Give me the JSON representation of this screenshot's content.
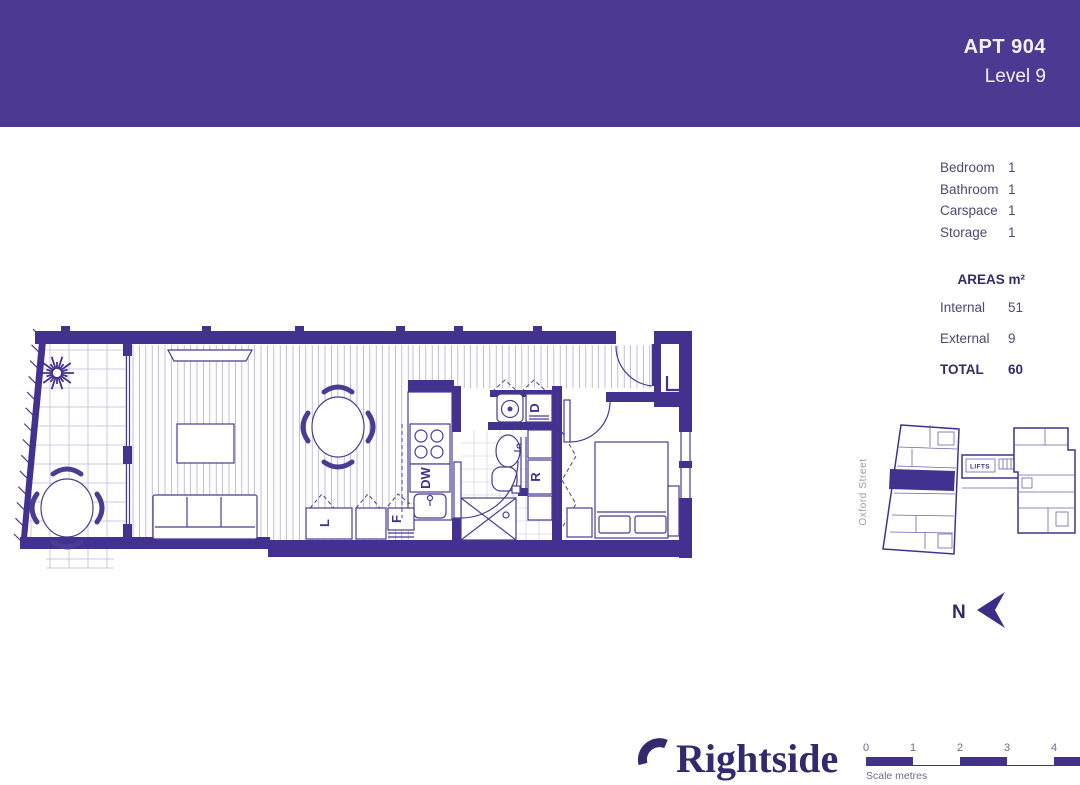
{
  "header": {
    "apt": "APT 904",
    "level": "Level 9"
  },
  "summary": {
    "rows": [
      {
        "label": "Bedroom",
        "value": "1"
      },
      {
        "label": "Bathroom",
        "value": "1"
      },
      {
        "label": "Carspace",
        "value": "1"
      },
      {
        "label": "Storage",
        "value": "1"
      }
    ]
  },
  "areas": {
    "title": "AREAS m²",
    "rows": [
      {
        "label": "Internal",
        "value": "51"
      },
      {
        "label": "External",
        "value": "9"
      }
    ],
    "total_label": "TOTAL",
    "total_value": "60"
  },
  "floorplan": {
    "labels": {
      "laundry_cupboard": "L",
      "fridge": "F",
      "dishwasher": "DW",
      "dryer": "D",
      "robe": "R",
      "entry_storage": "L"
    }
  },
  "keyplan": {
    "street": "Oxford Street",
    "lifts": "LIFTS"
  },
  "compass": {
    "north": "N"
  },
  "logo": {
    "brand": "Rightside"
  },
  "scalebar": {
    "ticks": [
      "0",
      "1",
      "2",
      "3",
      "4"
    ],
    "caption": "Scale metres"
  },
  "colors": {
    "header_purple": "#4a3a92",
    "wall_purple": "#42318f",
    "line_purple": "#4a3b93",
    "highlight_unit": "#42318f",
    "text_dark": "#322b6b",
    "text_muted": "#4f4870",
    "street_gray": "#9b9b9b"
  }
}
